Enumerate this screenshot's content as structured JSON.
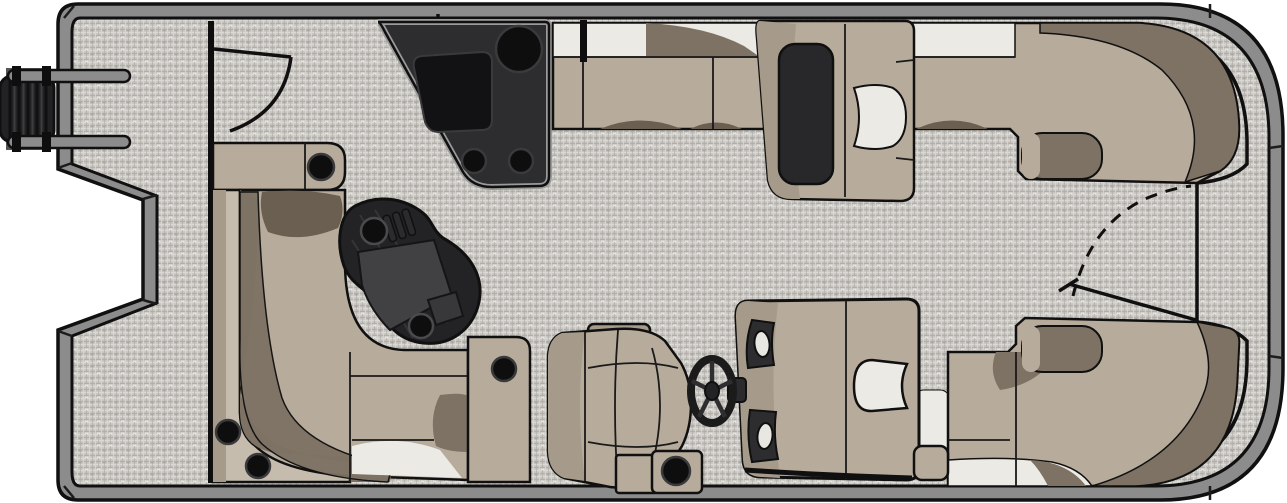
{
  "meta": {
    "title": "Pontoon Boat Floor Plan",
    "view": "top-down floorplan diagram",
    "aria_label": "Top-down floor plan of a pontoon boat with aft wraparound lounge, kidney-shaped table, port console, bow benches, chaise lounge, helm console with steering wheel, captain's chair and outboard motor"
  },
  "colors": {
    "outline": "#101010",
    "hull_band": "#8c8c8c",
    "deck_base": "#c6c3be",
    "deck_line_light": "#dbd9d5",
    "deck_line_dark": "#b1aea9",
    "deck_fleck_light": "#efede9",
    "deck_fleck_dark": "#8e8b86",
    "seat": "#b7ac9c",
    "seat_light": "#c6bcae",
    "seat_mid": "#a69b8a",
    "seat_dark": "#7d7263",
    "seat_shadow": "#6a5f51",
    "cushion_white": "#eceae4",
    "console_dark": "#2d2d2f",
    "console_rim": "#9a9a9a",
    "black": "#0e0e0e",
    "table_top": "#232325",
    "table_panel": "#414143",
    "gauge_white": "#e8e7e2",
    "wheel": "#1b1b1b"
  },
  "components": [
    {
      "id": "outboard-motor",
      "label": "Outboard motor"
    },
    {
      "id": "stern-platform",
      "label": "Stern platform"
    },
    {
      "id": "stern-gate",
      "label": "Stern gate with swing arc"
    },
    {
      "id": "aft-wraparound-lounge",
      "label": "Aft wraparound lounge with cupholders"
    },
    {
      "id": "dinette-table",
      "label": "Kidney-shaped dinette table"
    },
    {
      "id": "port-console",
      "label": "Port utility console with sink and basin"
    },
    {
      "id": "port-bow-bench",
      "label": "Port bow bench"
    },
    {
      "id": "port-chaise",
      "label": "Port chaise lounge chair"
    },
    {
      "id": "bow-gate",
      "label": "Bow gate with swing arc"
    },
    {
      "id": "starboard-bow-bench",
      "label": "Starboard bow bench"
    },
    {
      "id": "helm-console",
      "label": "Helm console with gauges and windscreen"
    },
    {
      "id": "steering-wheel",
      "label": "Steering wheel"
    },
    {
      "id": "captain-chair",
      "label": "Captain's chair"
    },
    {
      "id": "storage-step",
      "label": "Storage step with cupholder"
    }
  ]
}
